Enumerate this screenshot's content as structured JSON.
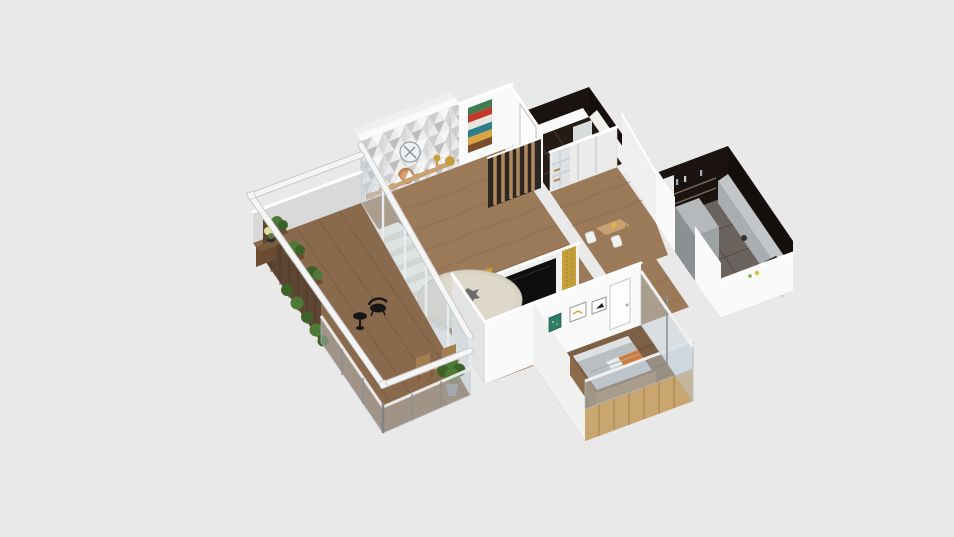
{
  "view": {
    "kind": "3d-floorplan-dollhouse-render",
    "background_plain": true,
    "has_visible_text": false
  },
  "colors": {
    "bg": "#e9e9e9",
    "wall": "#fafafa",
    "wall-2": "#f0f0ef",
    "wall-3": "#e3e3e3",
    "wall-low": "#d9d9d9",
    "cap": "#ffffff",
    "floor-wood": "#9b7a5a",
    "floor-wood-dark": "#85674a",
    "floor-deck": "#8a6a4d",
    "floor-deck-dark": "#74583e",
    "floor-bedroom": "#7d5f44",
    "floor-bed-dark": "#64482f",
    "floor-kitchen": "#6a625c",
    "dark-tile": "#241b15",
    "dark-wall": "#1b1310",
    "dark-wall-2": "#140f0c",
    "glass": "rgba(193,208,216,0.42)",
    "glass-stroke": "#aebbc1",
    "gold": "#c59f3c",
    "tv": "#0e0e0e",
    "stair": "#f3f1ed",
    "stair-side": "#dedad4",
    "wood-warm": "#c8a272",
    "slat": "#b08a5e",
    "fence": "#5d4531",
    "planter": "#6b4b32",
    "plant": "#4e7a38",
    "plant-dark": "#3c6129",
    "chair-wood": "#b8905e",
    "black-furniture": "#161616",
    "bed-mattress": "#b9bec1",
    "bed-pillow": "#d0793a",
    "bed-frame": "#8b6b4a",
    "counter-front": "#a9adb0",
    "counter-top": "#c2c6c8",
    "table-top": "#d8d2c3",
    "accent-pattern-grays": [
      "#f7f7f7",
      "#ececec",
      "#d6d6d6",
      "#cdcdcd",
      "#bdbdbd"
    ],
    "artwork-stripes": [
      "#3f7d4e",
      "#c0392b",
      "#e8e4da",
      "#2a7f8a",
      "#d9a441",
      "#7a4e2a"
    ],
    "pinboard-green": "#2e7d66",
    "clock-face": "#eef0f1",
    "clock-copper": "#c98a5a"
  },
  "rooms": [
    {
      "id": "balcony-terrace",
      "depicts": [
        "wood deck",
        "glass railing",
        "wood privacy fence",
        "planter boxes with plants",
        "flower pot on cabinet",
        "black lounge chair",
        "black side table",
        "two wooden chairs",
        "small outdoor table",
        "potted plant"
      ]
    },
    {
      "id": "living-dining-room",
      "depicts": [
        "triangle-mosaic accent wall",
        "two wall clocks",
        "gold pendant lamp",
        "wood ledge with white triangle decor",
        "colorful chevron artwork",
        "white staircase",
        "round dining table",
        "media wall with TV and gold panels",
        "wood slat partition",
        "glazed wall to balcony"
      ]
    },
    {
      "id": "bathroom",
      "depicts": [
        "dark brown tiled floor and walls",
        "white shower panel",
        "white wall with door"
      ]
    },
    {
      "id": "entry-hall",
      "depicts": [
        "wardrobe with open shelves",
        "small wood table",
        "two light chairs",
        "yellow decor item"
      ]
    },
    {
      "id": "kitchen",
      "depicts": [
        "dark tiled walls",
        "open shelves with bottles",
        "gray counter with cooktop",
        "gray cabinet block",
        "white half wall",
        "white tall cabinet"
      ]
    },
    {
      "id": "bedroom",
      "depicts": [
        "bed with gray bedding and orange pillow",
        "wood slat headboard wall",
        "glass partition",
        "green pinboard",
        "two framed prints",
        "white door",
        "dark wood floor"
      ]
    }
  ]
}
